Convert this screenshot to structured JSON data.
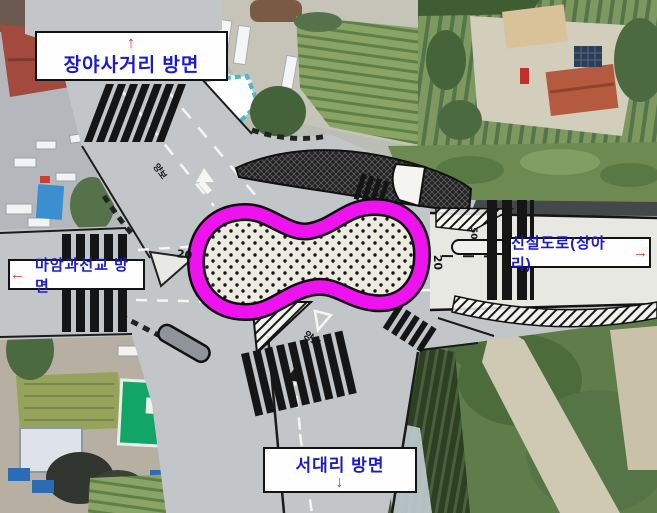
{
  "map": {
    "direction_labels": {
      "north": {
        "label": "장야사거리 방면",
        "arrow": "↑"
      },
      "west": {
        "label": "마암과선교 방면",
        "arrow": "←"
      },
      "east": {
        "label": "신설도로(상아리)",
        "arrow": "→"
      },
      "south": {
        "label": "서대리 방면",
        "arrow": "↓"
      }
    },
    "road_markings": {
      "speed_20_west": "20",
      "speed_20_east": "20",
      "speed_50_new_road": "50",
      "yield_south": "양보",
      "yield_north": "양보"
    },
    "colors": {
      "highlight_outline": "#ee12ee",
      "label_text_blue": "#1a1acd",
      "arrow_red": "#e0302a"
    }
  }
}
